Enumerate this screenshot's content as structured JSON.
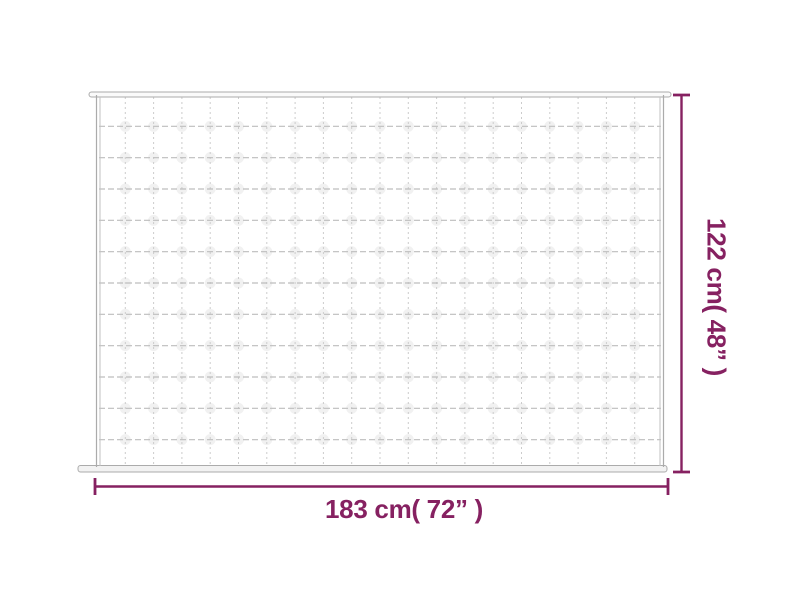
{
  "page": {
    "background_color": "#ffffff",
    "description": "Product dimension diagram of a quilted weighted blanket"
  },
  "product_diagram": {
    "blanket": {
      "grid_columns": 20,
      "grid_rows": 12,
      "outline_color": "#ababab",
      "edge_line_color": "#c2c2c2",
      "grid_vertical_color": "#cccccc",
      "grid_horizontal_color": "#bdbdbd",
      "puff_color": "#efefef",
      "fill_color": "#ffffff"
    },
    "dimensions": {
      "accent_color": "#862161",
      "width_label": "183 cm( 72” )",
      "height_label": "122 cm( 48” )"
    }
  }
}
